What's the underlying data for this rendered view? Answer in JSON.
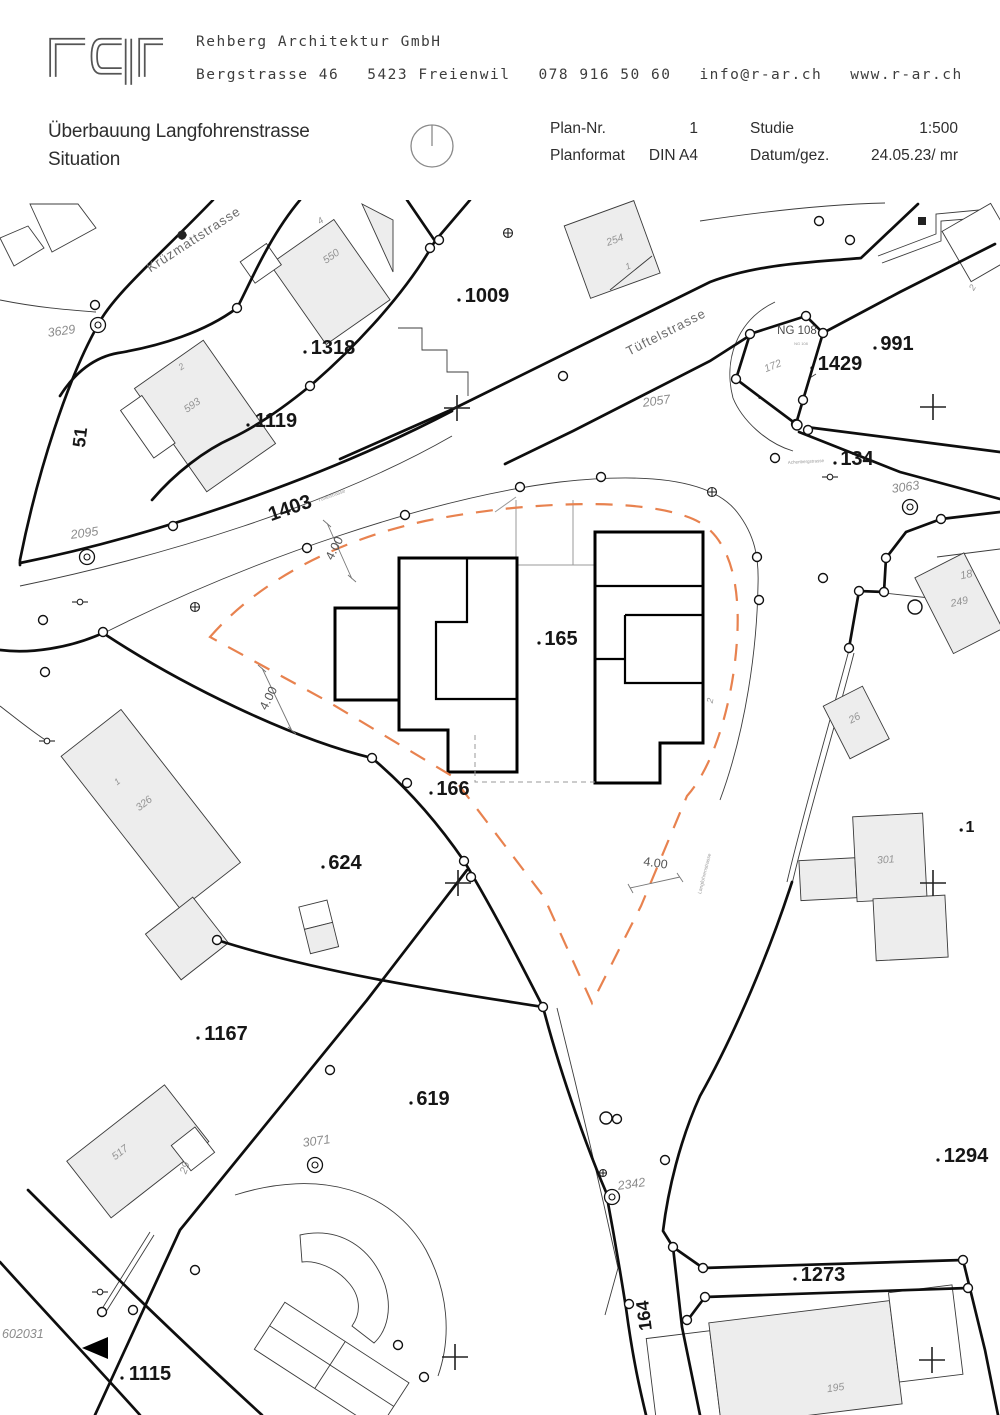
{
  "header": {
    "logo_text": "rar",
    "company": "Rehberg Architektur GmbH",
    "contact": [
      "Bergstrasse 46",
      "5423 Freienwil",
      "078 916 50 60",
      "info@r-ar.ch",
      "www.r-ar.ch"
    ]
  },
  "titleblock": {
    "project": "Überbauung Langfohrenstrasse",
    "sheet": "Situation",
    "fields": [
      {
        "label": "Plan-Nr.",
        "value": "1"
      },
      {
        "label": "Planformat",
        "value": "DIN A4"
      },
      {
        "label": "Studie",
        "value": "1:500"
      },
      {
        "label": "Datum/gez.",
        "value": "24.05.23/ mr"
      }
    ]
  },
  "map": {
    "colors": {
      "line": "#111111",
      "building_fill": "#ededed",
      "setback_dash": "#e8824f"
    },
    "labels": [
      {
        "t": "Krüzmattstrasse",
        "x": 196,
        "y": 243,
        "s": 13,
        "r": -33,
        "c": "street"
      },
      {
        "t": "Tüftelstrasse",
        "x": 668,
        "y": 336,
        "s": 13,
        "r": -27,
        "c": "street"
      },
      {
        "t": "Tüftelstrasse",
        "x": 332,
        "y": 497,
        "s": 5,
        "r": -20,
        "c": "tiny"
      },
      {
        "t": "Achenbergstrasse",
        "x": 806,
        "y": 463,
        "s": 4.5,
        "r": -3,
        "c": "tiny"
      },
      {
        "t": "Langfohrenstrasse",
        "x": 706,
        "y": 874,
        "s": 5,
        "r": -76,
        "c": "tiny"
      },
      {
        "t": "NG 108",
        "x": 797,
        "y": 334,
        "s": 11.5,
        "r": 0,
        "c": "ng"
      },
      {
        "t": "NG 108",
        "x": 801,
        "y": 345,
        "s": 4,
        "r": 0,
        "c": "tiny"
      },
      {
        "t": "1009",
        "x": 487,
        "y": 302,
        "s": 20,
        "r": 0,
        "c": "parcel"
      },
      {
        "t": "1318",
        "x": 333,
        "y": 354,
        "s": 20,
        "r": 0,
        "c": "parcel"
      },
      {
        "t": "1119",
        "x": 276,
        "y": 427,
        "s": 20,
        "r": 0,
        "c": "parcel"
      },
      {
        "t": "1403",
        "x": 292,
        "y": 514,
        "s": 20,
        "r": -19,
        "c": "parcel"
      },
      {
        "t": "51",
        "x": 86,
        "y": 438,
        "s": 18,
        "r": -83,
        "c": "parcel"
      },
      {
        "t": "165",
        "x": 561,
        "y": 645,
        "s": 20,
        "r": 0,
        "c": "parcel"
      },
      {
        "t": "166",
        "x": 453,
        "y": 795,
        "s": 20,
        "r": 0,
        "c": "parcel"
      },
      {
        "t": "624",
        "x": 345,
        "y": 869,
        "s": 20,
        "r": 0,
        "c": "parcel"
      },
      {
        "t": "1167",
        "x": 226,
        "y": 1040,
        "s": 20,
        "r": 0,
        "c": "parcel"
      },
      {
        "t": "619",
        "x": 433,
        "y": 1105,
        "s": 20,
        "r": 0,
        "c": "parcel"
      },
      {
        "t": "991",
        "x": 897,
        "y": 350,
        "s": 20,
        "r": 0,
        "c": "parcel"
      },
      {
        "t": "1429",
        "x": 840,
        "y": 370,
        "s": 20,
        "r": 0,
        "c": "parcel"
      },
      {
        "t": "134",
        "x": 857,
        "y": 465,
        "s": 20,
        "r": 0,
        "c": "parcel"
      },
      {
        "t": "1273",
        "x": 823,
        "y": 1281,
        "s": 20,
        "r": 0,
        "c": "parcel"
      },
      {
        "t": "1294",
        "x": 966,
        "y": 1162,
        "s": 20,
        "r": 0,
        "c": "parcel"
      },
      {
        "t": "1115",
        "x": 150,
        "y": 1380,
        "s": 20,
        "r": 0,
        "c": "parcel"
      },
      {
        "t": "164",
        "x": 650,
        "y": 1315,
        "s": 18,
        "r": -97,
        "c": "parcel"
      },
      {
        "t": "1",
        "x": 970,
        "y": 832,
        "s": 16,
        "r": 0,
        "c": "parcel"
      },
      {
        "t": "3629",
        "x": 62,
        "y": 335,
        "s": 12.5,
        "r": -8,
        "c": "point"
      },
      {
        "t": "2095",
        "x": 85,
        "y": 537,
        "s": 12.5,
        "r": -8,
        "c": "point"
      },
      {
        "t": "2057",
        "x": 657,
        "y": 405,
        "s": 12.5,
        "r": -8,
        "c": "point"
      },
      {
        "t": "3063",
        "x": 906,
        "y": 491,
        "s": 12.5,
        "r": -8,
        "c": "point"
      },
      {
        "t": "3071",
        "x": 317,
        "y": 1145,
        "s": 12.5,
        "r": -8,
        "c": "point"
      },
      {
        "t": "2342",
        "x": 632,
        "y": 1188,
        "s": 12.5,
        "r": -8,
        "c": "point"
      },
      {
        "t": "602031",
        "x": 2,
        "y": 1338,
        "s": 12.5,
        "r": 0,
        "c": "point",
        "a": "start"
      },
      {
        "t": "550",
        "x": 333,
        "y": 259,
        "s": 10.5,
        "r": -35,
        "c": "building"
      },
      {
        "t": "4",
        "x": 322,
        "y": 223,
        "s": 9,
        "r": -35,
        "c": "building"
      },
      {
        "t": "2",
        "x": 183,
        "y": 369,
        "s": 9,
        "r": -35,
        "c": "building"
      },
      {
        "t": "593",
        "x": 194,
        "y": 408,
        "s": 10.5,
        "r": -35,
        "c": "building"
      },
      {
        "t": "254",
        "x": 616,
        "y": 243,
        "s": 10.5,
        "r": -20,
        "c": "building"
      },
      {
        "t": "1",
        "x": 629,
        "y": 269,
        "s": 9,
        "r": -20,
        "c": "building"
      },
      {
        "t": "172",
        "x": 774,
        "y": 369,
        "s": 10.5,
        "r": -22,
        "c": "building"
      },
      {
        "t": "18",
        "x": 967,
        "y": 578,
        "s": 11,
        "r": -12,
        "c": "building"
      },
      {
        "t": "249",
        "x": 960,
        "y": 605,
        "s": 10.5,
        "r": -12,
        "c": "building"
      },
      {
        "t": "26",
        "x": 856,
        "y": 721,
        "s": 10.5,
        "r": -28,
        "c": "building"
      },
      {
        "t": "326",
        "x": 146,
        "y": 806,
        "s": 10.5,
        "r": -38,
        "c": "building"
      },
      {
        "t": "1",
        "x": 119,
        "y": 784,
        "s": 9,
        "r": -38,
        "c": "building"
      },
      {
        "t": "301",
        "x": 886,
        "y": 863,
        "s": 10.5,
        "r": -4,
        "c": "building"
      },
      {
        "t": "2",
        "x": 975,
        "y": 289,
        "s": 9,
        "r": -60,
        "c": "building"
      },
      {
        "t": "2",
        "x": 713,
        "y": 701,
        "s": 9,
        "r": -80,
        "c": "building"
      },
      {
        "t": "517",
        "x": 122,
        "y": 1155,
        "s": 10.5,
        "r": -38,
        "c": "building"
      },
      {
        "t": "29",
        "x": 188,
        "y": 1169,
        "s": 10.5,
        "r": -70,
        "c": "building"
      },
      {
        "t": "195",
        "x": 836,
        "y": 1391,
        "s": 10.5,
        "r": -8,
        "c": "building"
      },
      {
        "t": "4.00",
        "x": 338,
        "y": 550,
        "s": 12.5,
        "r": -63,
        "c": "dim"
      },
      {
        "t": "4.00",
        "x": 272,
        "y": 700,
        "s": 12.5,
        "r": -63,
        "c": "dim"
      },
      {
        "t": "4.00",
        "x": 655,
        "y": 867,
        "s": 12.5,
        "r": 8,
        "c": "dim"
      }
    ]
  }
}
